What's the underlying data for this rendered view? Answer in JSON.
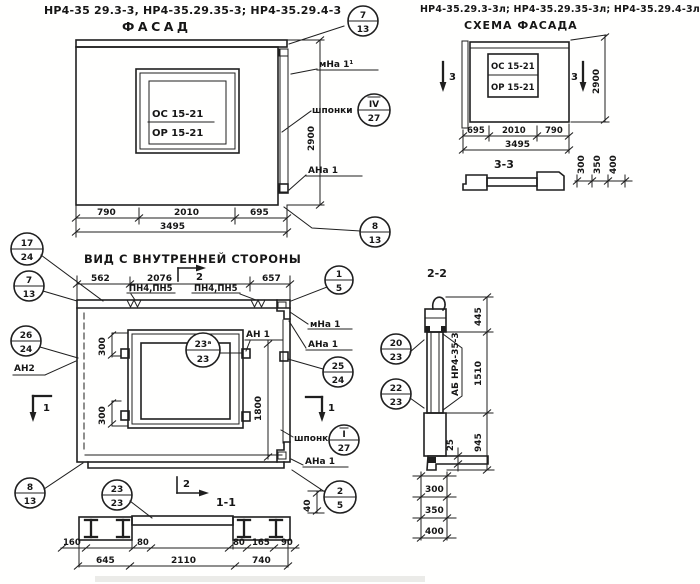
{
  "colors": {
    "ink": "#1f1f1f",
    "paper": "#ffffff"
  },
  "facade": {
    "title": "НР4-35 29.3-3, НР4-35.29.35-3; НР4-35.29.4-3",
    "view_label": "ФАСАД",
    "window": {
      "line1": "ОС 15-21",
      "line2": "ОР 15-21"
    },
    "dims": {
      "left": "790",
      "mid": "2010",
      "right": "695",
      "total": "3495",
      "height": "2900"
    },
    "labels": {
      "mna": "мНа 1¹",
      "shponki": "шпонки",
      "ana": "АНа 1"
    },
    "callouts": {
      "top": {
        "num": "7",
        "sheet": "13"
      },
      "key": {
        "num": "IV",
        "sheet": "27"
      },
      "bottom": {
        "num": "8",
        "sheet": "13"
      }
    }
  },
  "scheme": {
    "title": "НР4-35.29.3-3л; НР4-35.29.35-3л; НР4-35.29.4-3л",
    "view_label": "СХЕМА ФАСАДА",
    "window": {
      "line1": "ОС 15-21",
      "line2": "ОР 15-21"
    },
    "section_mark": "3",
    "dims": {
      "left": "695",
      "mid": "2010",
      "right": "790",
      "total": "3495",
      "height": "2900"
    },
    "profile": {
      "label": "3-3",
      "d1": "300",
      "d2": "350",
      "d3": "400"
    }
  },
  "inner": {
    "view_label": "ВИД С ВНУТРЕННЕЙ СТОРОНЫ",
    "anchor_label": "ПН4,ПН5",
    "dims": {
      "top1": "562",
      "top2": "2076",
      "top3": "657",
      "v300": "300",
      "v1800": "1800",
      "d40": "40"
    },
    "labels": {
      "mna": "мНа 1",
      "ana_top": "АНа 1",
      "ana_bottom": "АНа 1",
      "an1": "АН 1",
      "an2": "АН2",
      "shponki": "шпонки"
    },
    "markers": {
      "m1": "1",
      "m2": "2"
    },
    "callouts": {
      "c17": {
        "num": "17",
        "sheet": "24"
      },
      "c7": {
        "num": "7",
        "sheet": "13"
      },
      "c26": {
        "num": "26",
        "sheet": "24"
      },
      "c1": {
        "num": "1",
        "sheet": "5"
      },
      "c25": {
        "num": "25",
        "sheet": "24"
      },
      "key": {
        "num": "I",
        "sheet": "27"
      },
      "c23a": {
        "num": "23ᵃ",
        "sheet": "23"
      },
      "c2": {
        "num": "2",
        "sheet": "5"
      },
      "c23": {
        "num": "23",
        "sheet": "23"
      },
      "c8": {
        "num": "8",
        "sheet": "13"
      }
    }
  },
  "sec11": {
    "label": "1-1",
    "dims": {
      "d160": "160",
      "d80a": "80",
      "d80b": "80",
      "d165": "165",
      "d90": "90",
      "d645": "645",
      "d2110": "2110",
      "d740": "740"
    }
  },
  "sec22": {
    "label": "2-2",
    "beam_label": "АБ НР4-35-3",
    "dims": {
      "d445": "445",
      "d1510": "1510",
      "d945": "945",
      "d25": "25",
      "d300": "300",
      "d350": "350",
      "d400": "400"
    },
    "callouts": {
      "c20": {
        "num": "20",
        "sheet": "23"
      },
      "c22": {
        "num": "22",
        "sheet": "23"
      }
    }
  }
}
